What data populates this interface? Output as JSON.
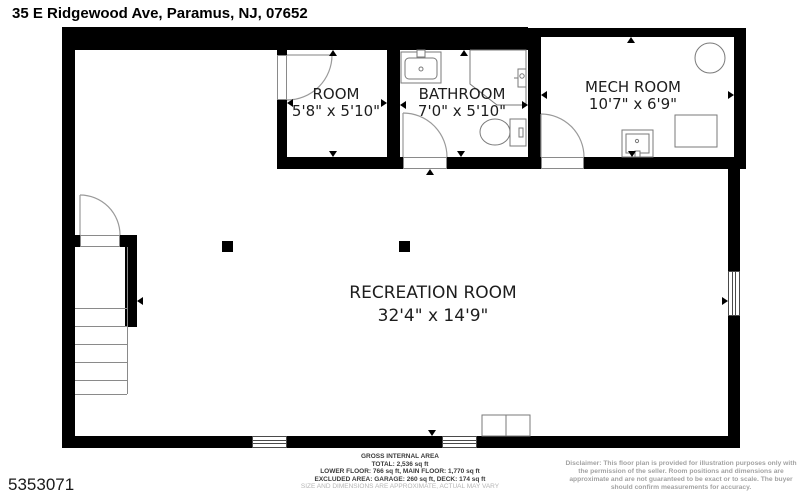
{
  "header": {
    "address": "35 E Ridgewood Ave, Paramus, NJ, 07652"
  },
  "mls_number": "5353071",
  "rooms": [
    {
      "name": "ROOM",
      "dims": "5'8\" x 5'10\""
    },
    {
      "name": "BATHROOM",
      "dims": "7'0\" x 5'10\""
    },
    {
      "name": "MECH ROOM",
      "dims": "10'7\" x 6'9\""
    },
    {
      "name": "RECREATION ROOM",
      "dims": "32'4\" x 14'9\""
    }
  ],
  "footer": {
    "area_title": "GROSS INTERNAL AREA",
    "total": "TOTAL: 2,536 sq ft",
    "floors": "LOWER FLOOR: 766 sq ft, MAIN FLOOR: 1,770 sq ft",
    "excluded": "EXCLUDED AREA: GARAGE: 260 sq ft, DECK: 174 sq ft",
    "note": "SIZE AND DIMENSIONS ARE APPROXIMATE, ACTUAL MAY VARY"
  },
  "disclaimer": {
    "line1": "Disclaimer: This floor plan is provided for illustration purposes only with",
    "line2": "the permission of the seller. Room positions and dimensions are",
    "line3": "approximate and are not guaranteed to be exact or to scale. The buyer",
    "line4": "should confirm measurements for accuracy."
  },
  "colors": {
    "wall": "#000000",
    "fixture_line": "#7a7a7a",
    "door_arc": "#9a9a9a",
    "label_text": "#1d1d1d",
    "footer_note": "#b5b5b5",
    "disclaimer_text": "#a3a3a3"
  }
}
